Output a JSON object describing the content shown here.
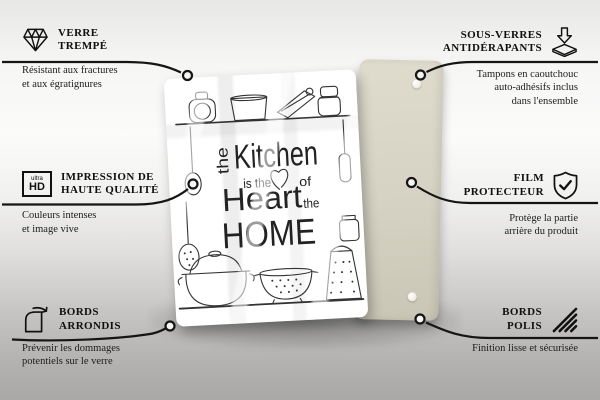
{
  "page": {
    "type": "product-feature-infographic",
    "product": "glass kitchen board / coaster set"
  },
  "colors": {
    "background_top": "#e7e7e6",
    "background_bottom": "#a9a8a6",
    "line": "#151515",
    "back_panel": "#d9d6c7",
    "glass": "#ffffff",
    "art_stroke": "#333333"
  },
  "callouts": {
    "top_left": {
      "icon": "diamond-icon",
      "title_line1": "VERRE",
      "title_line2": "TREMPÉ",
      "desc_line1": "Résistant aux fractures",
      "desc_line2": "et aux égratignures"
    },
    "top_right": {
      "icon": "coaster-pads-icon",
      "title_line1": "SOUS-VERRES",
      "title_line2": "ANTIDÉRAPANTS",
      "desc_line1": "Tampons en caoutchouc",
      "desc_line2": "auto-adhésifs inclus",
      "desc_line3": "dans l'ensemble"
    },
    "middle_left": {
      "icon": "ultra-hd-icon",
      "icon_text_top": "ultra",
      "icon_text_bottom": "HD",
      "title_line1": "IMPRESSION DE",
      "title_line2": "HAUTE QUALITÉ",
      "desc_line1": "Couleurs intenses",
      "desc_line2": "et image vive"
    },
    "middle_right": {
      "icon": "shield-check-icon",
      "title_line1": "FILM",
      "title_line2": "PROTECTEUR",
      "desc_line1": "Protège la partie",
      "desc_line2": "arrière du produit"
    },
    "bottom_left": {
      "icon": "rounded-corner-icon",
      "title_line1": "BORDS",
      "title_line2": "ARRONDIS",
      "desc_line1": "Prévenir les dommages",
      "desc_line2": "potentiels sur le verre"
    },
    "bottom_right": {
      "icon": "polished-edge-icon",
      "title_line1": "BORDS",
      "title_line2": "POLIS",
      "desc_line1": "Finition lisse et sécurisée"
    }
  },
  "product": {
    "design": {
      "word_the_vertical": "the",
      "word_kitchen": "Kitchen",
      "word_is_the": "is the",
      "word_of": "of",
      "word_heart": "Heart",
      "word_the": "the",
      "word_home": "HOME"
    }
  }
}
